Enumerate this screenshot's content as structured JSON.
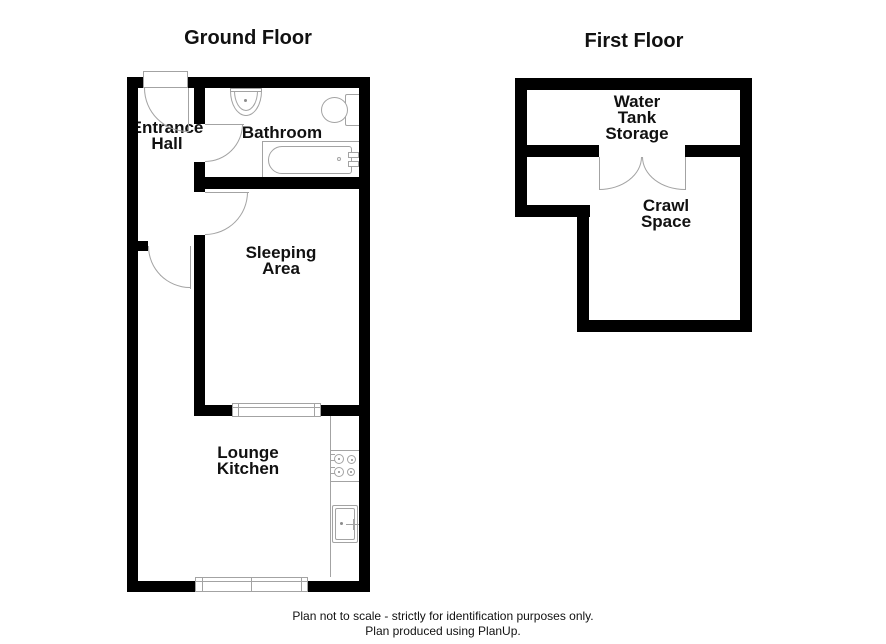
{
  "ground_floor": {
    "title": "Ground Floor",
    "rooms": {
      "entrance_hall": {
        "lines": [
          "Entrance",
          "Hall"
        ]
      },
      "bathroom": {
        "lines": [
          "Bathroom"
        ]
      },
      "sleeping_area": {
        "lines": [
          "Sleeping",
          "Area"
        ]
      },
      "lounge_kitchen": {
        "lines": [
          "Lounge",
          "Kitchen"
        ]
      }
    },
    "fixtures": [
      "basin-icon",
      "toilet-icon",
      "bath-icon",
      "hob-icon",
      "kitchen-sink-icon"
    ],
    "windows": 2,
    "doors": 4
  },
  "first_floor": {
    "title": "First Floor",
    "rooms": {
      "water_tank_storage": {
        "lines": [
          "Water",
          "Tank",
          "Storage"
        ]
      },
      "crawl_space": {
        "lines": [
          "Crawl",
          "Space"
        ]
      }
    },
    "doors": 1
  },
  "footer": {
    "disclaimer": "Plan not to scale - strictly for identification purposes only.",
    "credit": "Plan produced using PlanUp."
  },
  "colors": {
    "wall": "#000000",
    "fixture_line": "#a3a3a3",
    "text": "#111111",
    "background": "#ffffff"
  }
}
